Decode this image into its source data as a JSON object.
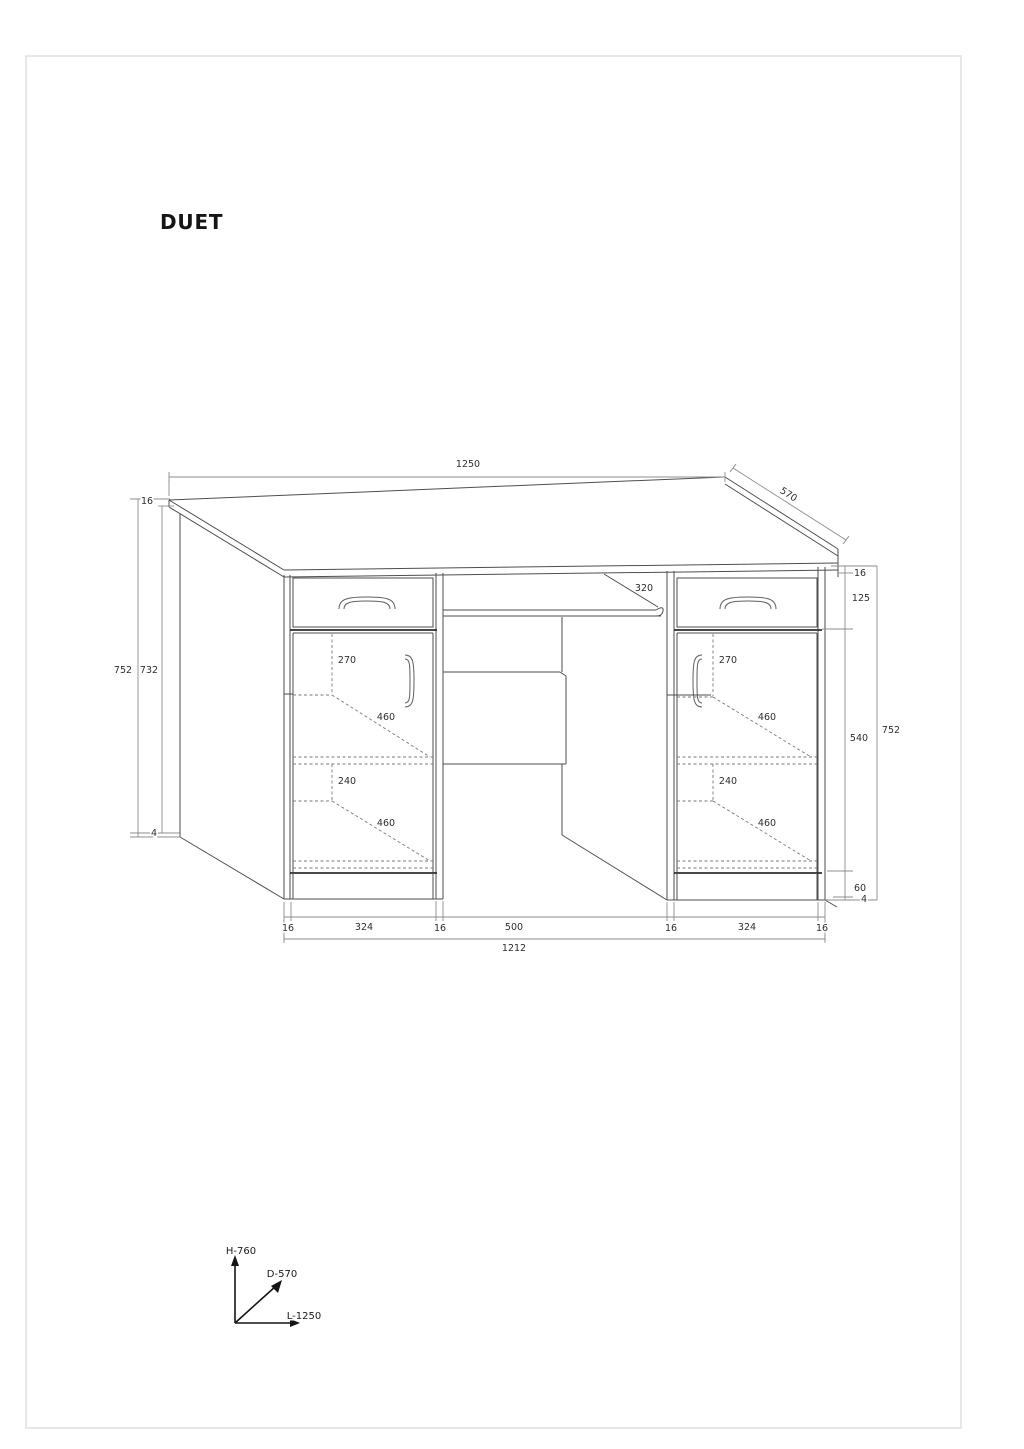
{
  "title": "DUET",
  "dims": {
    "width_top": "1250",
    "depth": "570",
    "tray_depth": "320",
    "left": {
      "top_thickness": "16",
      "overall": "752",
      "inner": "732",
      "foot": "4"
    },
    "right": {
      "top_thickness": "16",
      "drawer_section": "125",
      "door_section": "540",
      "overall": "752",
      "plinth": "60",
      "foot": "4"
    },
    "pedestal_left": {
      "shelf_top_height": "270",
      "shelf_top_depth": "460",
      "shelf_bottom_height": "240",
      "shelf_bottom_depth": "460"
    },
    "pedestal_right": {
      "shelf_top_height": "270",
      "shelf_top_depth": "460",
      "shelf_bottom_height": "240",
      "shelf_bottom_depth": "460"
    },
    "bottom": {
      "seg0": "16",
      "seg1": "324",
      "seg2": "16",
      "seg3": "500",
      "seg4": "16",
      "seg5": "324",
      "seg6": "16",
      "overall": "1212"
    }
  },
  "axes": {
    "height": "H-760",
    "depth": "D-570",
    "length": "L-1250"
  }
}
